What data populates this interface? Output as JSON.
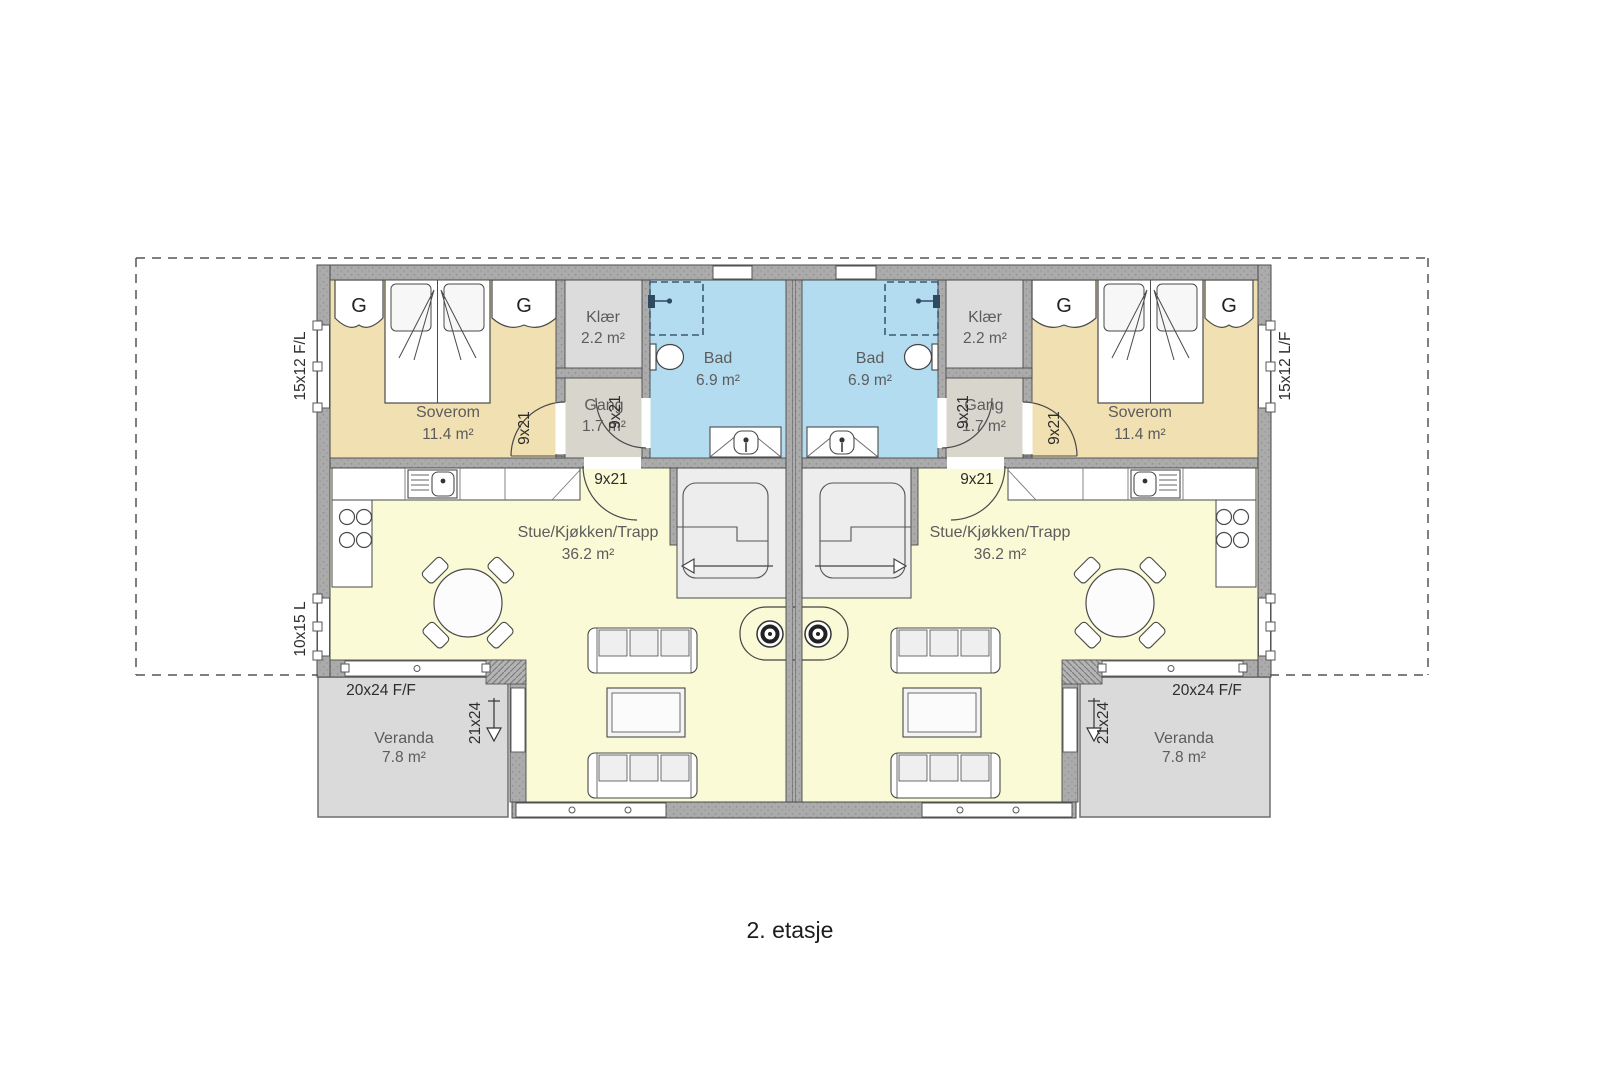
{
  "title": "2. etasje",
  "rooms": {
    "soverom": {
      "name": "Soverom",
      "area": "11.4 m²"
    },
    "klaer": {
      "name": "Klær",
      "area": "2.2 m²"
    },
    "bad": {
      "name": "Bad",
      "area": "6.9 m²"
    },
    "gang": {
      "name": "Gang",
      "area": "1.7 m²"
    },
    "stue": {
      "name": "Stue/Kjøkken/Trapp",
      "area": "36.2 m²"
    },
    "veranda": {
      "name": "Veranda",
      "area": "7.8 m²"
    }
  },
  "wardrobe_label": "G",
  "dimensions": {
    "interior_door": "9x21",
    "veranda_door": "21x24",
    "veranda_window": "20x24 F/F",
    "bedroom_window_left": "15x12 F/L",
    "bedroom_window_right": "15x12 L/F",
    "living_window_left": "10x15 L"
  },
  "colors": {
    "bedroom_floor": "#f0e0b2",
    "bathroom_floor": "#b4dcf0",
    "living_floor": "#fafad6",
    "closet_floor": "#dcdcdc",
    "hall_floor": "#d8d5cd",
    "veranda_floor": "#dadada",
    "stairs_floor": "#ededed",
    "wall": "#ababab",
    "line": "#4a4a4a",
    "shower": "#3d5a73"
  }
}
